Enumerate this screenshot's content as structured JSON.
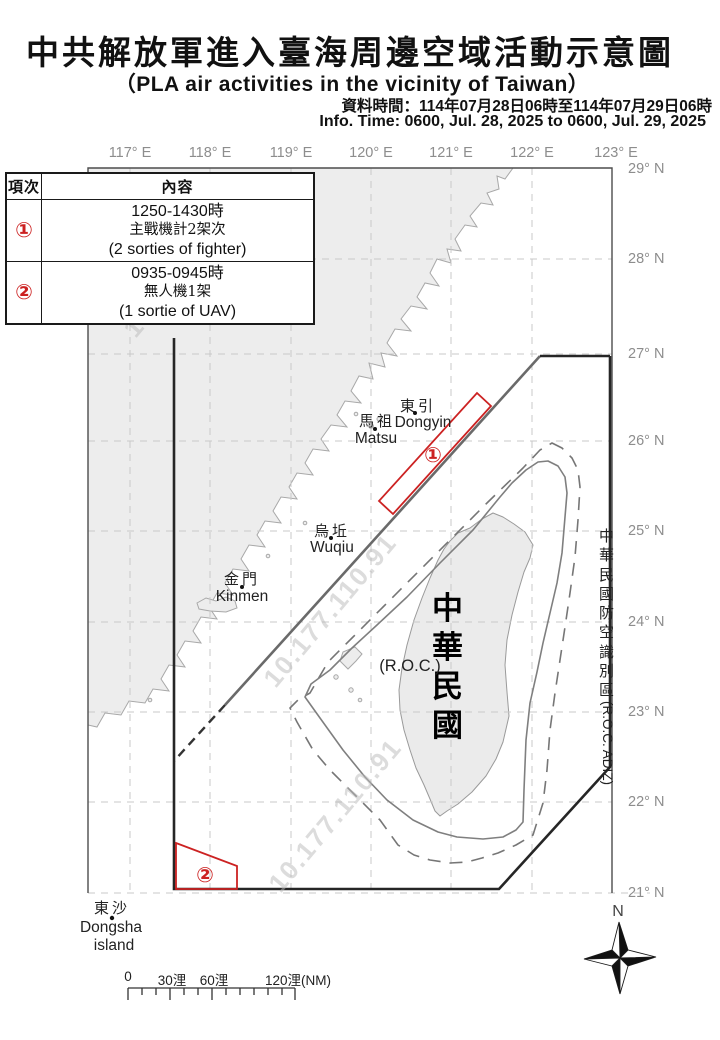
{
  "header": {
    "title_zh": "中共解放軍進入臺海周邊空域活動示意圖",
    "title_en": "（PLA air activities in the vicinity of Taiwan）",
    "data_time_zh": "資料時間：114年07月28日06時至114年07月29日06時",
    "info_time_en": "Info. Time: 0600, Jul. 28, 2025 to 0600, Jul. 29, 2025"
  },
  "table": {
    "col_item": "項次",
    "col_content": "內容",
    "rows": [
      {
        "no": "①",
        "time": "1250-1430時",
        "desc_zh": "主戰機計2架次",
        "desc_en": "(2 sorties of fighter)"
      },
      {
        "no": "②",
        "time": "0935-0945時",
        "desc_zh": "無人機1架",
        "desc_en": "(1 sortie of UAV)"
      }
    ]
  },
  "map": {
    "axes": {
      "lon": [
        "117° E",
        "118° E",
        "119° E",
        "120° E",
        "121° E",
        "122° E",
        "123° E"
      ],
      "lat": [
        "29° N",
        "28° N",
        "27° N",
        "26° N",
        "25° N",
        "24° N",
        "23° N",
        "22° N",
        "21° N"
      ]
    },
    "places": {
      "dongyin": {
        "zh": "東引",
        "en": "Dongyin"
      },
      "matsu": {
        "zh": "馬祖",
        "en": "Matsu"
      },
      "wuqiu": {
        "zh": "烏坵",
        "en": "Wuqiu"
      },
      "kinmen": {
        "zh": "金門",
        "en": "Kinmen"
      },
      "dongsha": {
        "zh": "東沙",
        "en_line1": "Dongsha",
        "en_line2": "island"
      }
    },
    "taiwan_label": "中華民國",
    "roc_label": "(R.O.C.)",
    "adiz_zh": "中華民國防空識別區",
    "adiz_en": "(R.O.C. ADIZ)",
    "markers": [
      "①",
      "②"
    ],
    "watermark": "10.177.110.91",
    "compass_n": "N",
    "scalebar": {
      "labels": [
        "0",
        "30浬",
        "60浬",
        "120浬(NM)"
      ]
    }
  },
  "colors": {
    "activity_red": "#cc2222",
    "land_fill": "#ededed",
    "adiz_line": "#262626",
    "grid": "#cccccc",
    "axis_gray": "#8d8d8d"
  }
}
